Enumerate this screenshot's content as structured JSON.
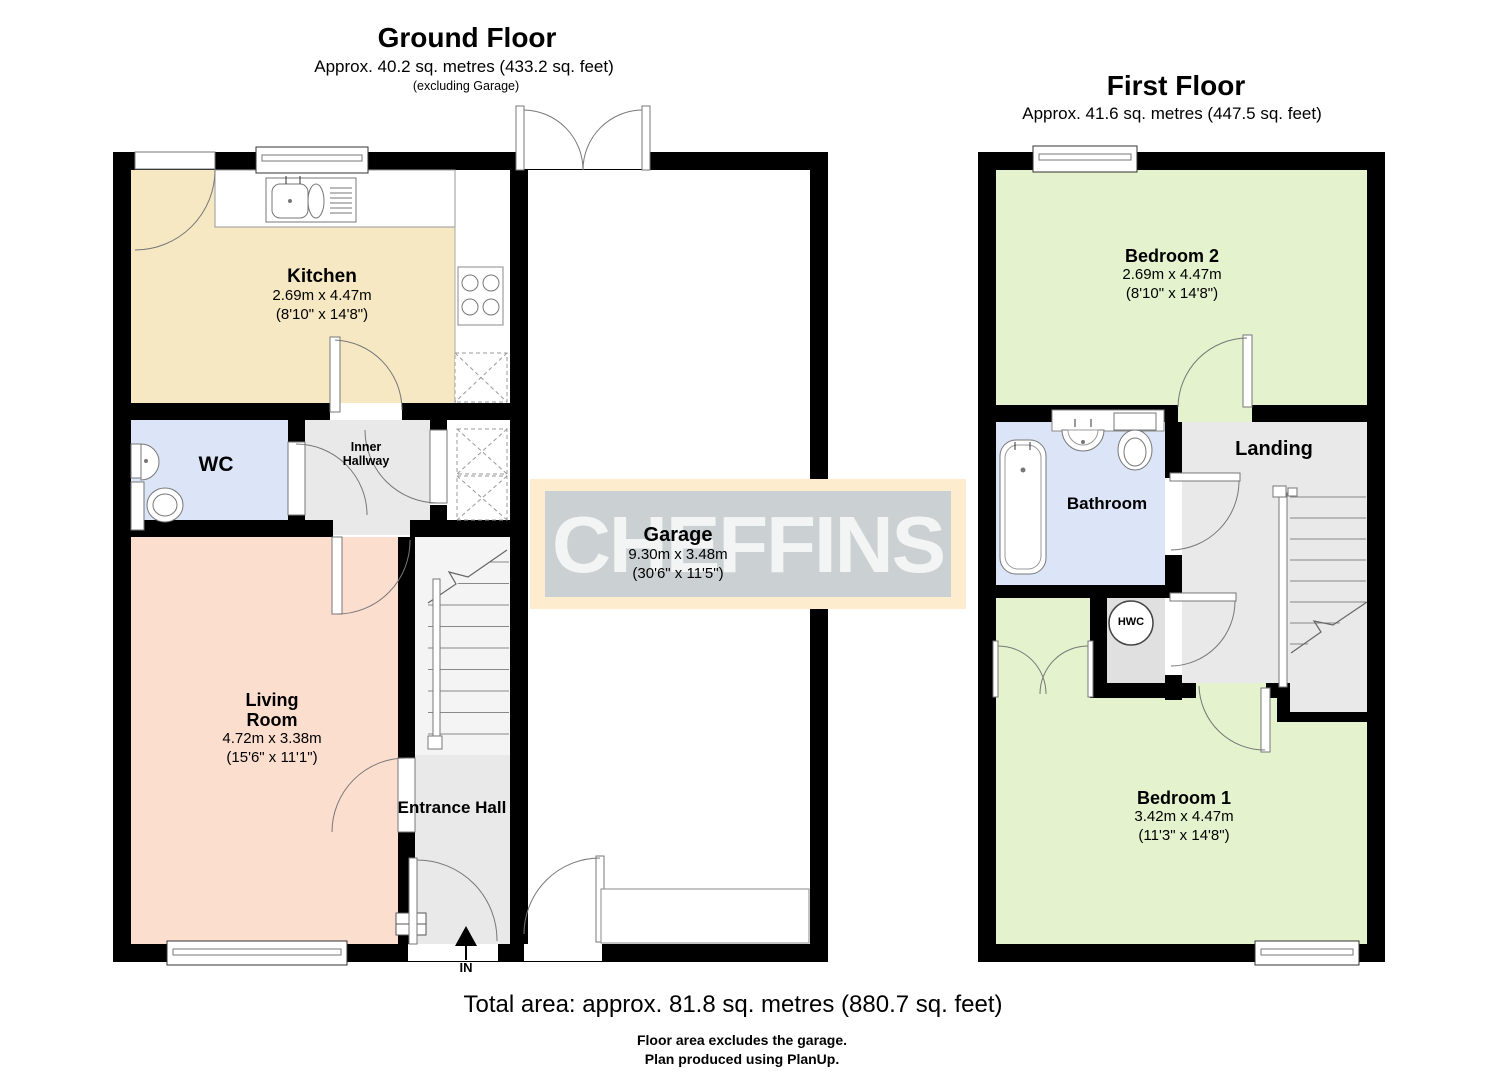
{
  "ground_floor": {
    "title": "Ground Floor",
    "subtitle": "Approx. 40.2 sq. metres (433.2 sq. feet)",
    "note": "(excluding Garage)",
    "entry_label": "IN",
    "rooms": {
      "kitchen": {
        "name": "Kitchen",
        "size_metric": "2.69m x 4.47m",
        "size_imperial": "(8'10\" x 14'8\")"
      },
      "wc": {
        "name": "WC"
      },
      "inner_hallway": {
        "name": "Inner Hallway"
      },
      "garage": {
        "name": "Garage",
        "size_metric": "9.30m x 3.48m",
        "size_imperial": "(30'6\" x 11'5\")"
      },
      "living_room": {
        "name": "Living Room",
        "size_metric": "4.72m x 3.38m",
        "size_imperial": "(15'6\" x 11'1\")"
      },
      "entrance_hall": {
        "name": "Entrance Hall"
      }
    }
  },
  "first_floor": {
    "title": "First Floor",
    "subtitle": "Approx. 41.6 sq. metres (447.5 sq. feet)",
    "rooms": {
      "bedroom_2": {
        "name": "Bedroom 2",
        "size_metric": "2.69m x 4.47m",
        "size_imperial": "(8'10\" x 14'8\")"
      },
      "landing": {
        "name": "Landing"
      },
      "bathroom": {
        "name": "Bathroom"
      },
      "hwc": {
        "name": "HWC"
      },
      "bedroom_1": {
        "name": "Bedroom 1",
        "size_metric": "3.42m x 4.47m",
        "size_imperial": "(11'3\" x 14'8\")"
      }
    }
  },
  "watermark": {
    "text": "CHEFFINS"
  },
  "footer": {
    "total_area": "Total area: approx. 81.8 sq. metres (880.7 sq. feet)",
    "note_1": "Floor area excludes the garage.",
    "note_2": "Plan produced using PlanUp."
  },
  "colors": {
    "wall": "#000000",
    "kitchen": "#f6e8c3",
    "wc_bathroom": "#dbe5f7",
    "living_room": "#fcdecf",
    "hallway_landing": "#e9e9e9",
    "bedroom": "#e4f2cd",
    "hwc_room": "#e0e0e0",
    "stairs": "#f4f4f4",
    "watermark_border": "#fdeccd",
    "watermark_bg": "#cbd1d2",
    "watermark_text": "#f3f5f4"
  }
}
